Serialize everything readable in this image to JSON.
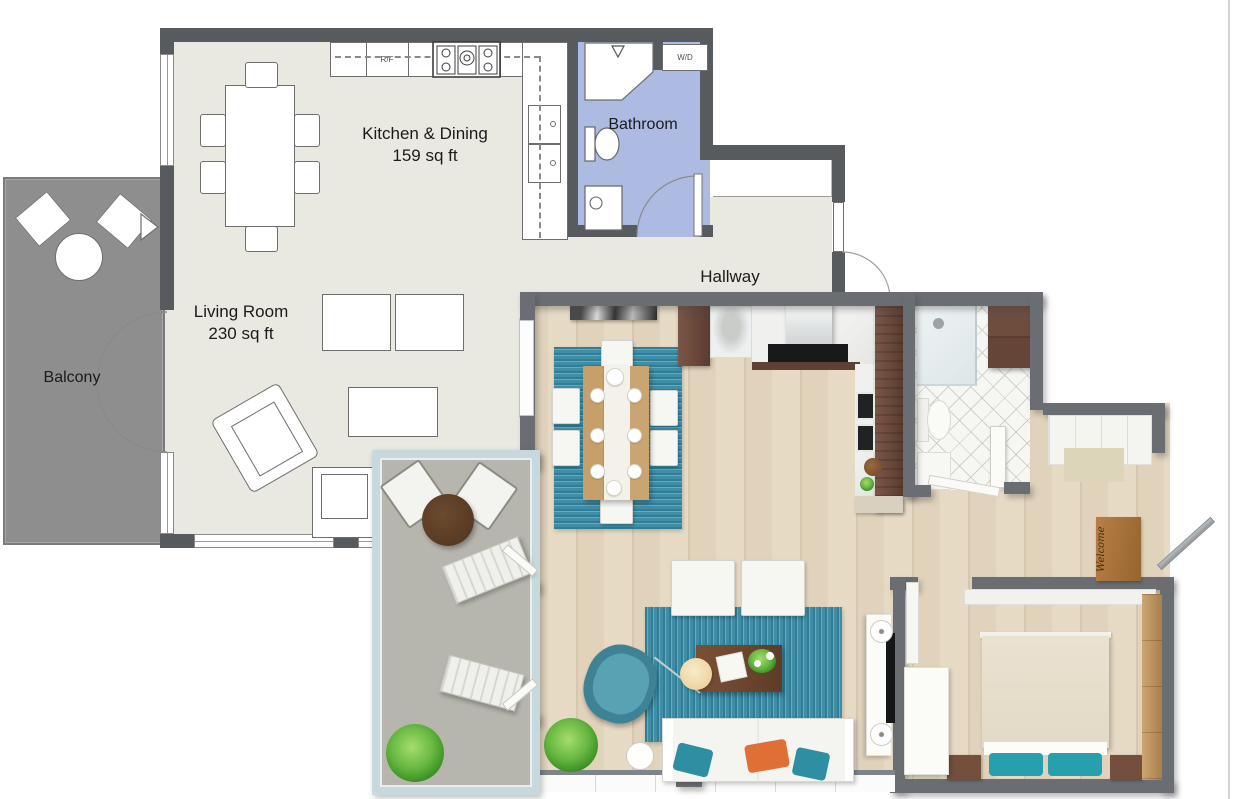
{
  "plan2d": {
    "rooms": {
      "kitchen": {
        "name": "Kitchen & Dining",
        "area": "159 sq ft"
      },
      "living": {
        "name": "Living Room",
        "area": "230 sq ft"
      },
      "balcony": {
        "name": "Balcony"
      },
      "bathroom": {
        "name": "Bathroom"
      },
      "hallway": {
        "name": "Hallway"
      }
    },
    "appliances": {
      "refrigerator": "R/F",
      "washer_dryer": "W/D"
    }
  },
  "plan3d": {
    "doormat_text": "Welcome"
  },
  "colors": {
    "wall_2d": "#575b5e",
    "floor_2d": "#e9e8e1",
    "balcony_floor_2d": "#8e8e8e",
    "bathroom_floor_2d": "#adbbe3",
    "wall_3d": "#6a6e72",
    "wood_floor": "#e8ddc9",
    "rug_teal": "#3f8ea6",
    "accent_teal": "#2aa0ac",
    "accent_orange": "#e06f35",
    "cabinet_brown": "#6b4a3c",
    "doormat_brown": "#a9713d"
  }
}
